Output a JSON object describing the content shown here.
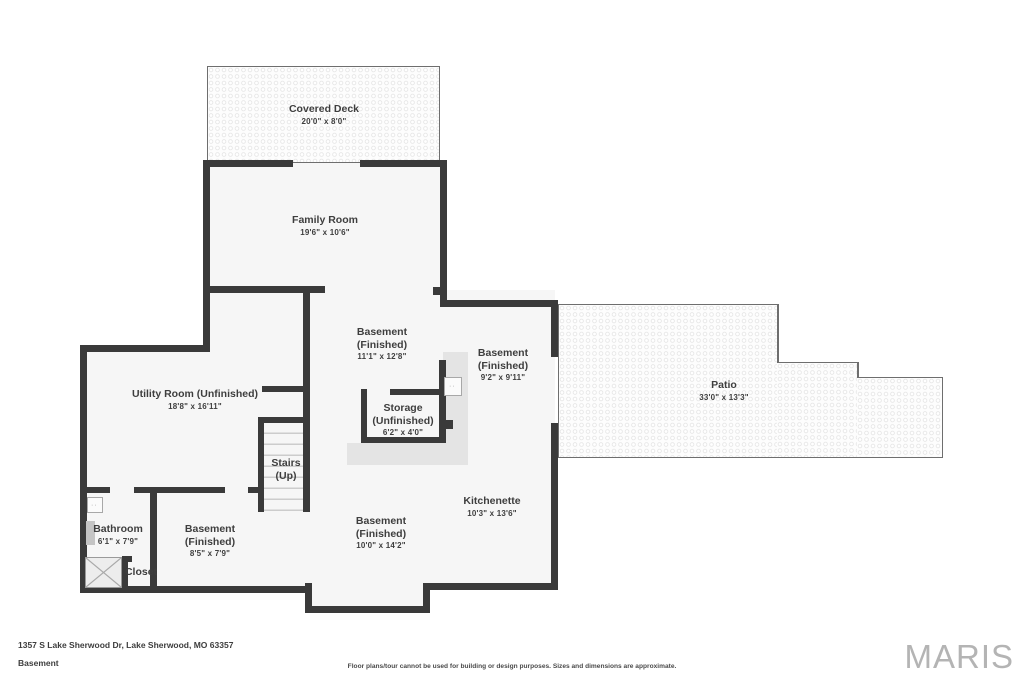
{
  "rooms": {
    "deck": {
      "name": "Covered Deck",
      "dims": "20'0\" x 8'0\""
    },
    "family": {
      "name": "Family Room",
      "dims": "19'6\" x 10'6\""
    },
    "bsmt_ne": {
      "name": "Basement",
      "qualifier": "(Finished)",
      "dims": "11'1\" x 12'8\""
    },
    "bsmt_e": {
      "name": "Basement",
      "qualifier": "(Finished)",
      "dims": "9'2\" x 9'11\""
    },
    "storage": {
      "name": "Storage",
      "qualifier": "(Unfinished)",
      "dims": "6'2\" x 4'0\""
    },
    "utility": {
      "name": "Utility Room (Unfinished)",
      "dims": "18'8\" x 16'11\""
    },
    "stairs": {
      "name": "Stairs",
      "qualifier": "(Up)"
    },
    "kitchenette": {
      "name": "Kitchenette",
      "dims": "10'3\" x 13'6\""
    },
    "bsmt_s": {
      "name": "Basement",
      "qualifier": "(Finished)",
      "dims": "10'0\" x 14'2\""
    },
    "bathroom": {
      "name": "Bathroom",
      "dims": "6'1\" x 7'9\""
    },
    "bsmt_sw": {
      "name": "Basement",
      "qualifier": "(Finished)",
      "dims": "8'5\" x 7'9\""
    },
    "closet": {
      "name": "Closet"
    },
    "patio": {
      "name": "Patio",
      "dims": "33'0\" x 13'3\""
    }
  },
  "footer": {
    "address": "1357 S Lake Sherwood Dr, Lake Sherwood, MO 63357",
    "level": "Basement",
    "disclaimer": "Floor plans/tour cannot be used for building or design purposes. Sizes and dimensions are approximate.",
    "brand": "MARIS"
  },
  "colors": {
    "wall": "#3a3a3a",
    "floor": "#f6f6f6",
    "shaded_area": "#e4e4e4",
    "outdoor_border": "#6e6e6e",
    "text": "#3e3e3e",
    "brand": "#b4b4b4"
  }
}
